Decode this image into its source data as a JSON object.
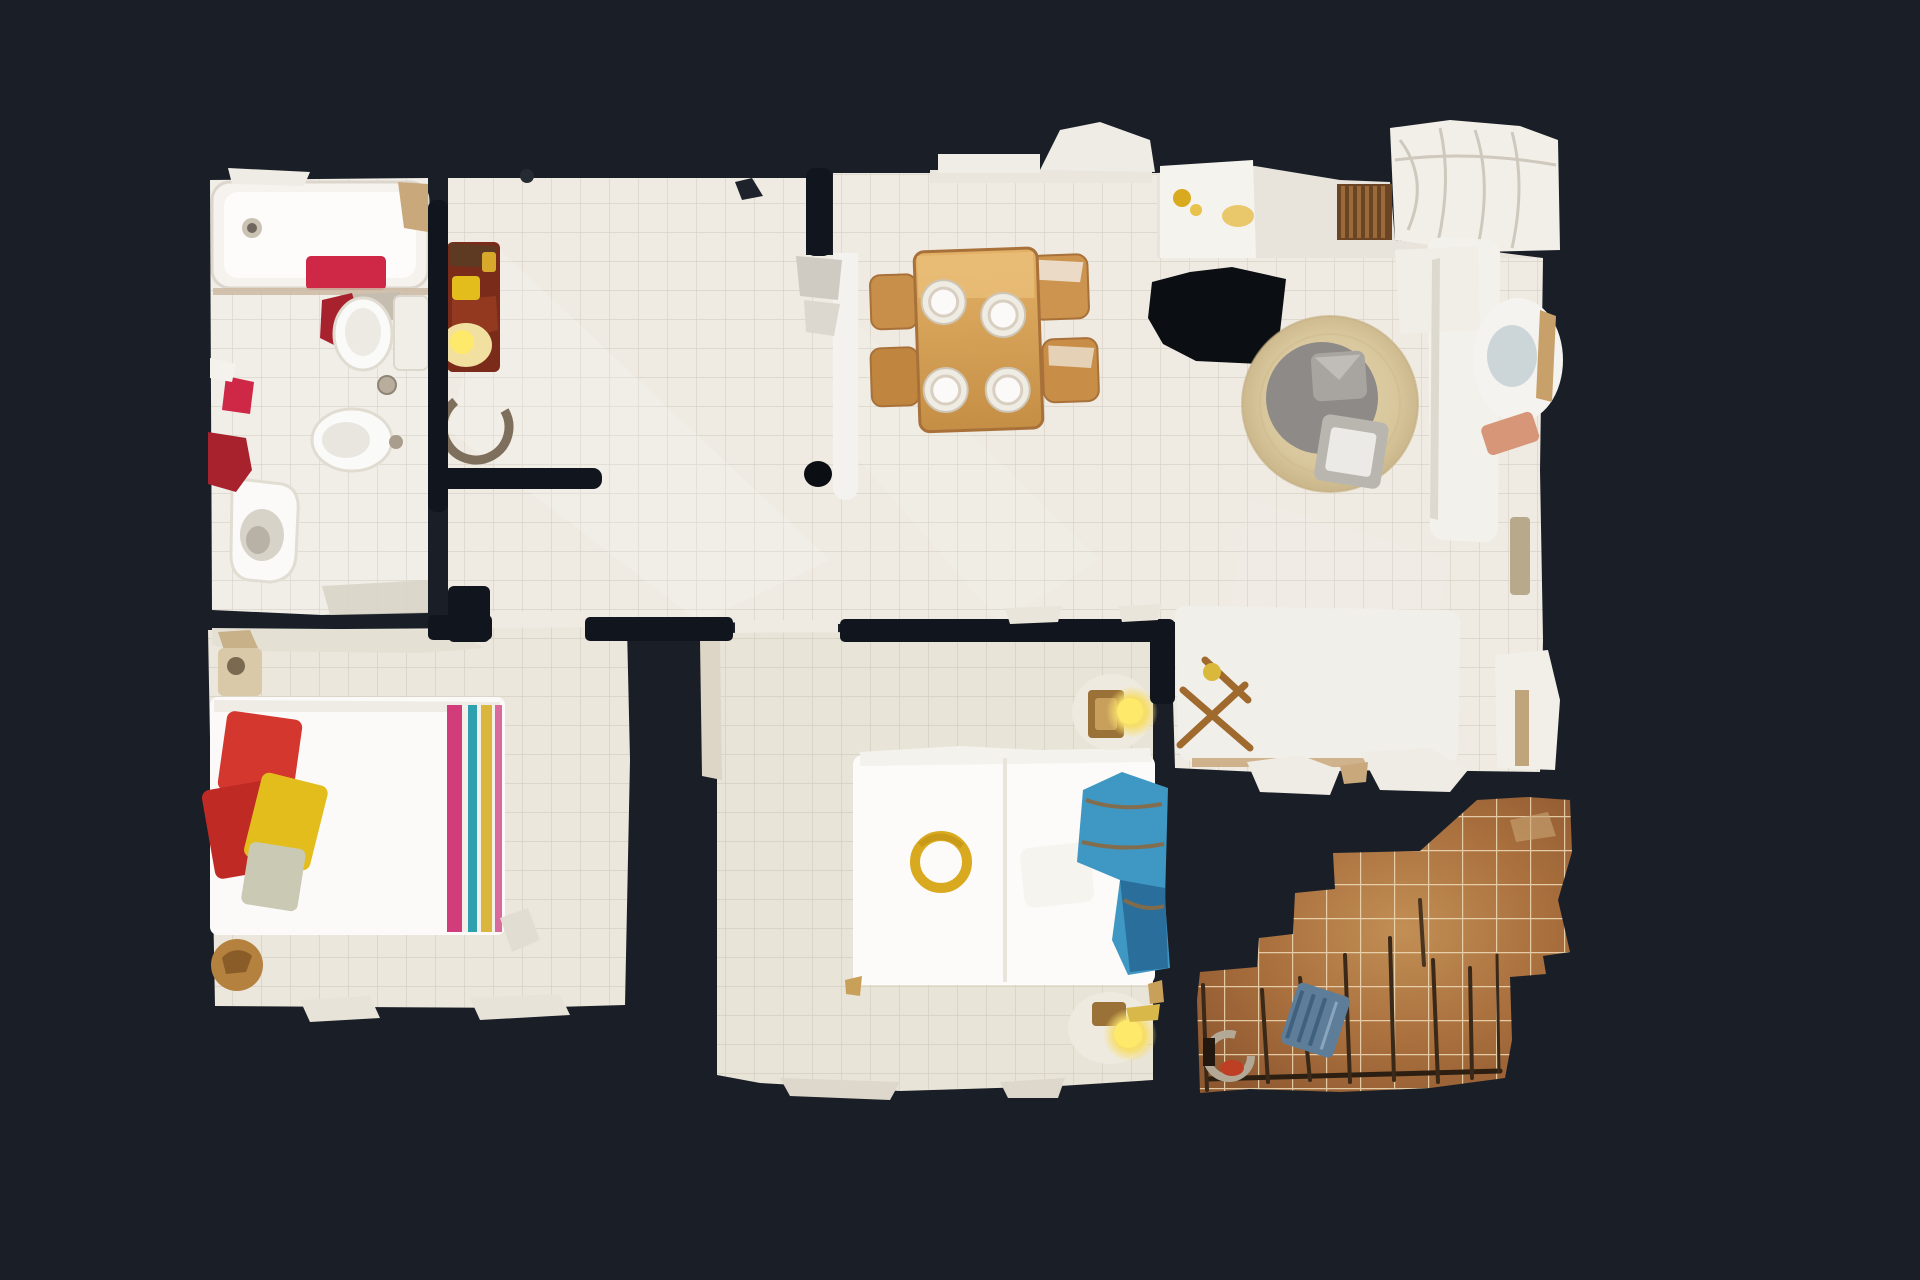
{
  "scene": {
    "view_label": "top-down-dollhouse-floor-plan-scan",
    "background": "#1a1f27"
  },
  "palette": {
    "bg": "#1a1f27",
    "void": "#0b0e12",
    "wallDark": "#11161e",
    "floorMain": "#efebe3",
    "floorBath": "#f1eee8",
    "floorBedL": "#ece7dc",
    "floorBedM": "#e9e4d8",
    "wallWhite": "#f2efe9",
    "white": "#f7f5f1",
    "tub": "#f6f3ee",
    "towel": "#cf2746",
    "crimson": "#a8222e",
    "woodTable": "#d8a55c",
    "woodDark": "#a9713a",
    "plate": "#fbfaf8",
    "rug": "#d8c69c",
    "rugShadow": "#8d8a87",
    "pouf": "#a8a5a0",
    "sofa": "#f3f1eb",
    "terracotta": "#d89678",
    "maroon": "#7b2b1a",
    "yellow": "#e3bd1c",
    "glow": "#ffe96a",
    "stripePink": "#d13c7a",
    "stripeTeal": "#2fa0ad",
    "stripeYellow": "#dcb53c",
    "stripeRose": "#d96a9b",
    "pillowRed": "#d4372e",
    "pillowRed2": "#c02a24",
    "pillowSage": "#c9c9b4",
    "blueThrow": "#3f97c4",
    "blueDark": "#2a6e9c",
    "gold": "#d9a91f",
    "nightWood": "#9a7136",
    "terrTile": "#b07a42",
    "terrGrout": "#dcc9a2",
    "rail": "#322416",
    "chairBlue": "#5d7d99",
    "doorArc": "#7d6f5c",
    "grille": "#6b4423"
  },
  "rooms": [
    {
      "id": "bathroom",
      "label": "bathroom with bathtub, toilet, bidet and sink"
    },
    {
      "id": "entry-hall",
      "label": "entry hall with maroon console chair and lamp"
    },
    {
      "id": "corridor",
      "label": "corridor connecting bathroom and bedrooms"
    },
    {
      "id": "dining-area",
      "label": "dining area with wooden table, four plates and four chairs"
    },
    {
      "id": "living-room",
      "label": "living room with round jute rug, poufs, sofa, armchair and daybed"
    },
    {
      "id": "kitchen-nook",
      "label": "kitchen nook with counter and gold fixtures"
    },
    {
      "id": "bedroom-1",
      "label": "bedroom with white bed, red and yellow pillows and striped runner"
    },
    {
      "id": "bedroom-2",
      "label": "bedroom with white double bed, blue throw and glowing bedside lamps"
    },
    {
      "id": "terrace",
      "label": "terrace with terracotta tiles, railing and chair"
    }
  ],
  "furniture": {
    "bathroom": [
      "bathtub",
      "toilet",
      "bidet",
      "sink",
      "red-towels"
    ],
    "dining": [
      "wood-table",
      "plates-x4",
      "chairs-x4"
    ],
    "living": [
      "round-rug",
      "gray-poufs",
      "white-sofa",
      "armchair",
      "daybed-bench",
      "x-frame-rack"
    ],
    "bedroom1": [
      "double-bed",
      "pillows",
      "striped-runner",
      "nightstand",
      "wood-stool"
    ],
    "bedroom2": [
      "double-bed",
      "gold-ornament",
      "white-pillow",
      "blue-throw",
      "nightstand-lamp-x2"
    ],
    "terrace": [
      "tile-floor",
      "railing",
      "blue-chair",
      "gray-ring-table"
    ]
  }
}
